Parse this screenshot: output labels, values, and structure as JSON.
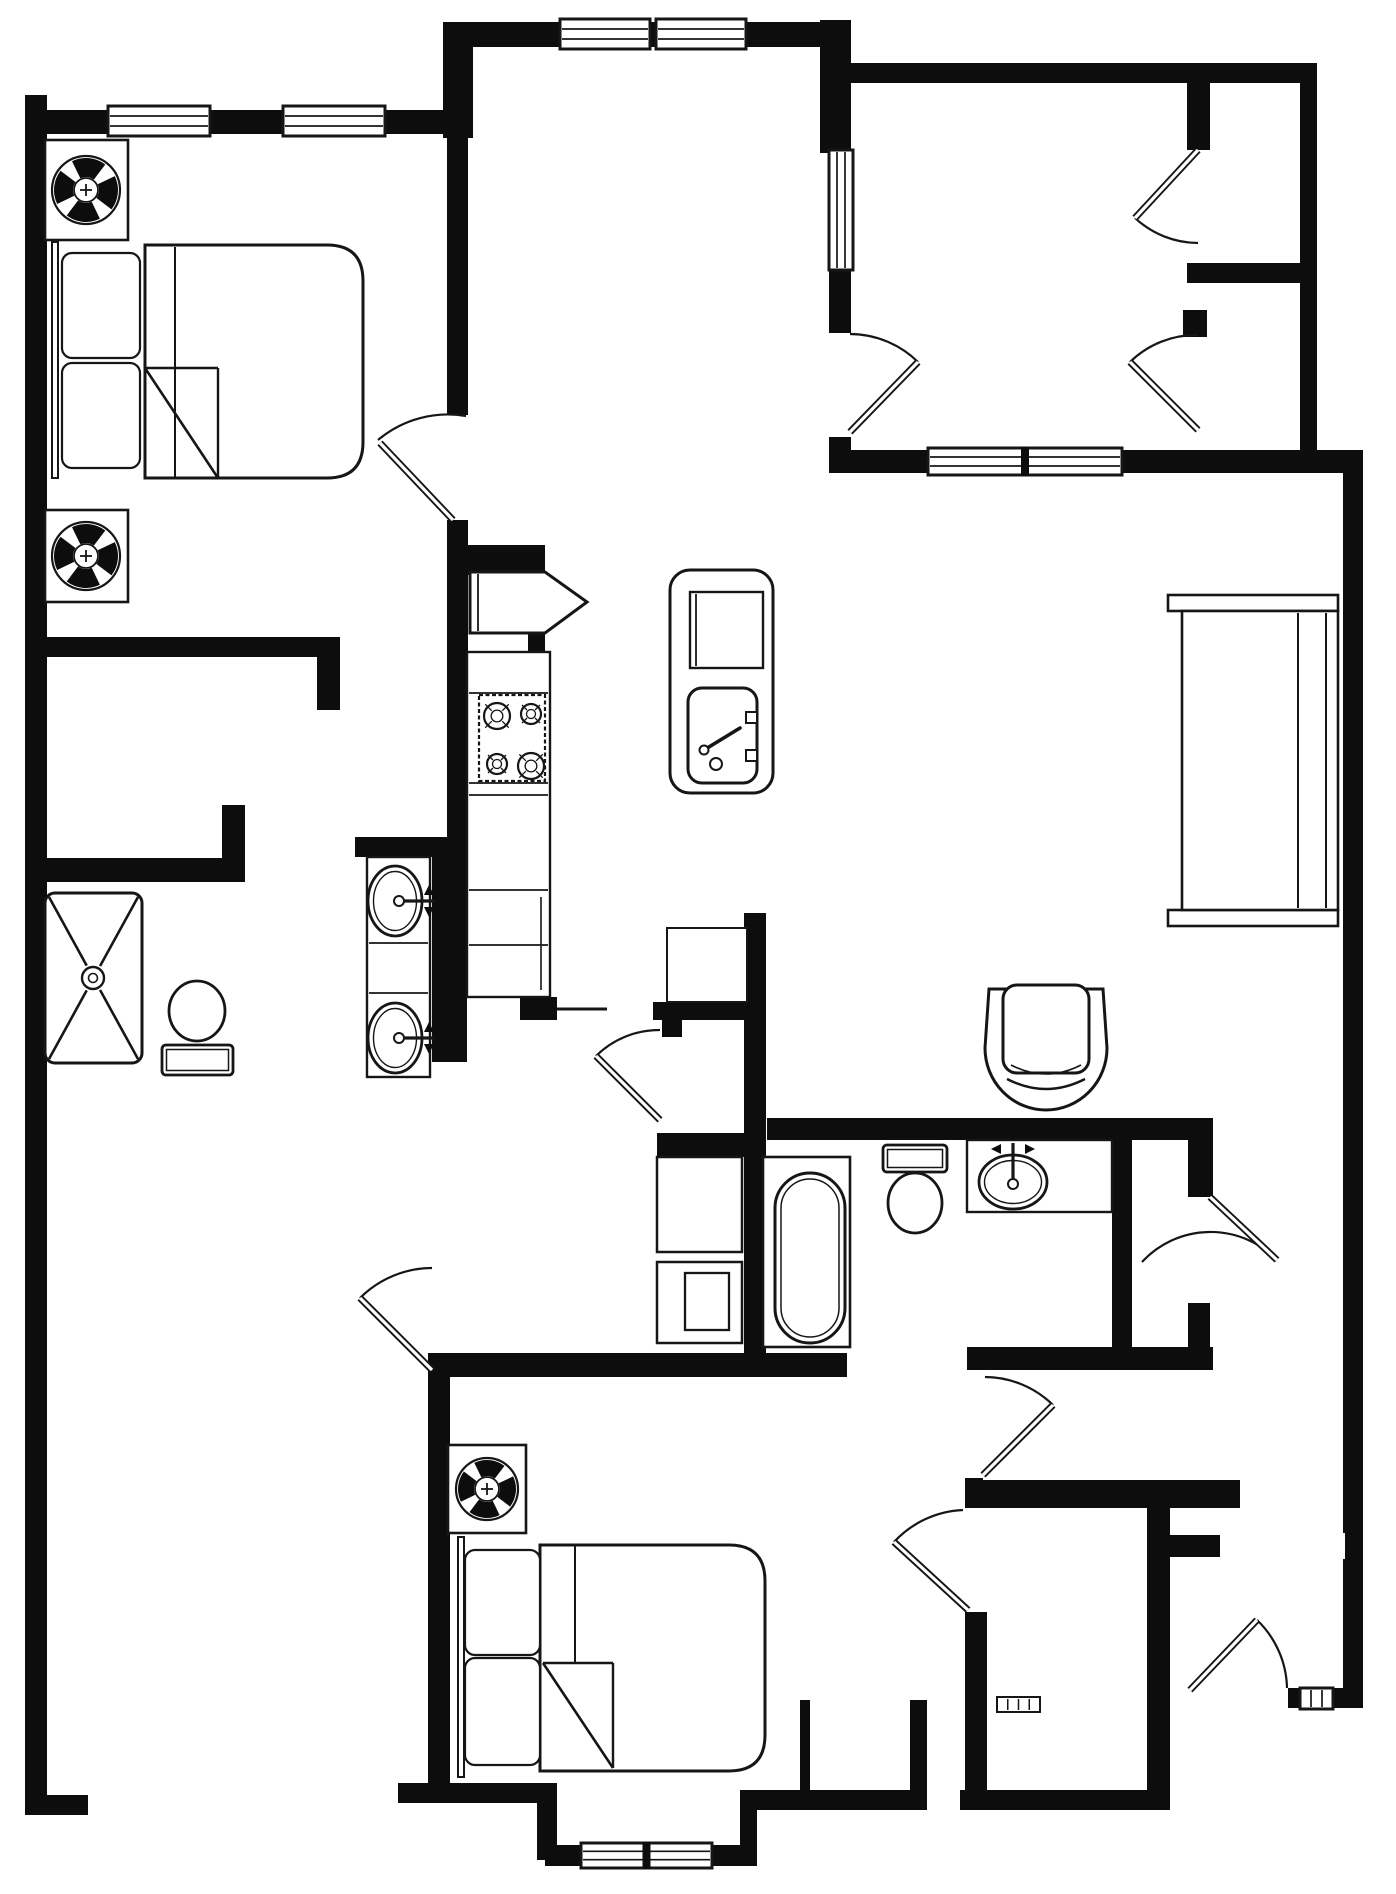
{
  "plan": {
    "type": "floor-plan",
    "canvas": {
      "w": 1396,
      "h": 1894
    },
    "colors": {
      "wall": "#0d0d0d",
      "line": "#161616",
      "bg": "#ffffff"
    },
    "walls": [
      [
        25,
        95,
        22,
        1702
      ],
      [
        25,
        1795,
        63,
        20
      ],
      [
        25,
        110,
        423,
        24
      ],
      [
        443,
        22,
        30,
        116
      ],
      [
        443,
        22,
        394,
        25
      ],
      [
        820,
        20,
        31,
        133
      ],
      [
        837,
        63,
        480,
        20
      ],
      [
        1300,
        63,
        17,
        410
      ],
      [
        829,
        267,
        22,
        66
      ],
      [
        829,
        437,
        22,
        36
      ],
      [
        837,
        450,
        95,
        23
      ],
      [
        1118,
        450,
        229,
        23
      ],
      [
        1343,
        450,
        20,
        1258
      ],
      [
        1187,
        263,
        113,
        20
      ],
      [
        1187,
        83,
        23,
        67
      ],
      [
        1183,
        310,
        24,
        27
      ],
      [
        43,
        637,
        297,
        20
      ],
      [
        317,
        657,
        23,
        53
      ],
      [
        43,
        858,
        202,
        20
      ],
      [
        222,
        805,
        23,
        73
      ],
      [
        27,
        860,
        218,
        22
      ],
      [
        355,
        837,
        99,
        20
      ],
      [
        447,
        132,
        21,
        283
      ],
      [
        447,
        520,
        21,
        330
      ],
      [
        447,
        545,
        98,
        30
      ],
      [
        528,
        633,
        17,
        20
      ],
      [
        432,
        837,
        35,
        225
      ],
      [
        520,
        997,
        37,
        23
      ],
      [
        653,
        1002,
        94,
        18
      ],
      [
        662,
        1020,
        20,
        17
      ],
      [
        744,
        913,
        22,
        464
      ],
      [
        657,
        1133,
        90,
        24
      ],
      [
        767,
        1118,
        446,
        22
      ],
      [
        1112,
        1140,
        20,
        218
      ],
      [
        1188,
        1140,
        25,
        57
      ],
      [
        1188,
        1303,
        22,
        55
      ],
      [
        967,
        1347,
        246,
        23
      ],
      [
        428,
        1353,
        419,
        24
      ],
      [
        428,
        1353,
        22,
        437
      ],
      [
        398,
        1783,
        159,
        20
      ],
      [
        537,
        1803,
        20,
        57
      ],
      [
        545,
        1845,
        212,
        21
      ],
      [
        740,
        1790,
        17,
        76
      ],
      [
        753,
        1790,
        174,
        20
      ],
      [
        800,
        1700,
        10,
        90
      ],
      [
        910,
        1700,
        17,
        90
      ],
      [
        965,
        1478,
        18,
        30
      ],
      [
        965,
        1480,
        275,
        28
      ],
      [
        1147,
        1507,
        23,
        303
      ],
      [
        965,
        1612,
        22,
        178
      ],
      [
        960,
        1790,
        210,
        20
      ],
      [
        1170,
        1535,
        50,
        22
      ],
      [
        1288,
        1688,
        55,
        20
      ]
    ],
    "notches": [
      [
        1333,
        1533,
        12,
        26
      ]
    ],
    "windows": [
      [
        108,
        106,
        102,
        30,
        "h",
        0
      ],
      [
        283,
        106,
        102,
        30,
        "h",
        0
      ],
      [
        560,
        19,
        90,
        30,
        "h",
        0
      ],
      [
        656,
        19,
        90,
        30,
        "h",
        0
      ],
      [
        829,
        150,
        24,
        120,
        "v",
        0
      ],
      [
        928,
        448,
        194,
        27,
        "h",
        1
      ],
      [
        581,
        1843,
        131,
        25,
        "h",
        1
      ],
      [
        1300,
        1688,
        33,
        21,
        "v",
        0
      ]
    ],
    "doors": [
      {
        "name": "bedroom-1-door",
        "hinge": [
          453,
          520
        ],
        "leaf": [
          380,
          443
        ],
        "arc": [
          378,
          440,
          108,
          466,
          416,
          1
        ]
      },
      {
        "name": "upper-closet-door",
        "hinge": [
          1198,
          150
        ],
        "leaf": [
          1135,
          218
        ],
        "arc": [
          1198,
          243,
          93,
          1135,
          218,
          1
        ]
      },
      {
        "name": "lower-closet-door",
        "hinge": [
          1198,
          430
        ],
        "leaf": [
          1130,
          362
        ],
        "arc": [
          1130,
          362,
          95,
          1198,
          335,
          1
        ]
      },
      {
        "name": "right-room-door",
        "hinge": [
          850,
          432
        ],
        "leaf": [
          918,
          362
        ],
        "arc": [
          850,
          334,
          98,
          918,
          362,
          1
        ]
      },
      {
        "name": "laundry-door",
        "hinge": [
          660,
          1120
        ],
        "leaf": [
          596,
          1056
        ],
        "arc": [
          660,
          1030,
          90,
          596,
          1056,
          0
        ]
      },
      {
        "name": "suite-hall-door",
        "hinge": [
          432,
          1370
        ],
        "leaf": [
          360,
          1298
        ],
        "arc": [
          432,
          1268,
          102,
          360,
          1298,
          0
        ]
      },
      {
        "name": "bath-hall-door",
        "hinge": [
          983,
          1475
        ],
        "leaf": [
          1053,
          1405
        ],
        "arc": [
          985,
          1377,
          98,
          1053,
          1405,
          1
        ]
      },
      {
        "name": "bedroom-2-door",
        "hinge": [
          968,
          1610
        ],
        "leaf": [
          894,
          1542
        ],
        "arc": [
          963,
          1510,
          100,
          894,
          1542,
          0
        ]
      },
      {
        "name": "master-bedroom-door",
        "hinge": [
          1210,
          1197
        ],
        "leaf": [
          1277,
          1260
        ],
        "arc": [
          1142,
          1262,
          93,
          1277,
          1260,
          1
        ]
      },
      {
        "name": "entry-door",
        "hinge": [
          1190,
          1690
        ],
        "leaf": [
          1257,
          1620
        ],
        "arc": [
          1287,
          1688,
          97,
          1257,
          1620,
          0
        ]
      }
    ],
    "lines": [
      [
        557,
        1009,
        607,
        1009
      ]
    ],
    "fans": [
      {
        "box": [
          45,
          140,
          83,
          100
        ],
        "cx": 86,
        "cy": 190,
        "r": 34
      },
      {
        "box": [
          45,
          510,
          83,
          92
        ],
        "cx": 86,
        "cy": 556,
        "r": 34
      },
      {
        "box": [
          448,
          1445,
          78,
          88
        ],
        "cx": 487,
        "cy": 1489,
        "r": 31
      }
    ],
    "beds": [
      {
        "name": "bed-1",
        "headboard": [
          52,
          242,
          6,
          236
        ],
        "pillows": [
          [
            62,
            253,
            78,
            105
          ],
          [
            62,
            363,
            78,
            105
          ]
        ],
        "mattress": [
          145,
          245,
          218,
          233
        ],
        "rx": 36,
        "blanket": [
          175,
          247,
          175,
          477
        ],
        "fold": [
          145,
          368,
          218,
          478
        ]
      },
      {
        "name": "bed-2",
        "headboard": [
          458,
          1537,
          6,
          240
        ],
        "pillows": [
          [
            465,
            1550,
            75,
            105
          ],
          [
            465,
            1658,
            75,
            107
          ]
        ],
        "mattress": [
          540,
          1545,
          225,
          226
        ],
        "rx": 36,
        "blanket": [
          575,
          1546,
          575,
          1663
        ],
        "fold": [
          543,
          1663,
          613,
          1768
        ]
      }
    ],
    "kitchen": {
      "counter": {
        "outer": [
          467,
          652,
          83,
          345
        ],
        "hlines": [
          693,
          783,
          795,
          890,
          945
        ],
        "vline": [
          541,
          897,
          990
        ]
      },
      "stove": {
        "rect": [
          479,
          695,
          66,
          86
        ],
        "burners": [
          [
            497,
            716,
            13
          ],
          [
            531,
            714,
            10
          ],
          [
            497,
            764,
            10
          ],
          [
            531,
            766,
            13
          ]
        ]
      },
      "fridge": {
        "poly": [
          [
            470,
            572
          ],
          [
            545,
            572
          ],
          [
            587,
            602
          ],
          [
            545,
            633
          ],
          [
            470,
            633
          ]
        ],
        "inner": [
          478,
          574,
          478,
          631
        ]
      },
      "island": {
        "outer": [
          670,
          570,
          103,
          223
        ],
        "board": [
          690,
          592,
          73,
          76
        ],
        "boardline": [
          696,
          594,
          696,
          666
        ],
        "sink": [
          688,
          688,
          69,
          95
        ],
        "drain": [
          716,
          764,
          6
        ],
        "lever": [
          [
            704,
            750
          ],
          [
            740,
            728
          ]
        ],
        "knobs": [
          [
            746,
            712,
            11,
            11
          ],
          [
            746,
            750,
            11,
            11
          ]
        ]
      }
    },
    "bath1": {
      "shower": {
        "rect": [
          45,
          893,
          97,
          170
        ],
        "drain": [
          93,
          978,
          11
        ]
      },
      "toilet": {
        "tank": [
          162,
          1045,
          71,
          30
        ],
        "bowl": [
          197,
          1011,
          28,
          30
        ],
        "tank_on_top": true
      },
      "vanity": {
        "counter": [
          367,
          857,
          63,
          220
        ],
        "dividers": [
          943,
          993
        ],
        "sinks": [
          [
            395,
            901,
            27,
            35
          ],
          [
            395,
            1038,
            27,
            35
          ]
        ],
        "dir": "right"
      }
    },
    "bath2": {
      "laundry": {
        "washer": [
          657,
          1157,
          85,
          95
        ],
        "dryer": [
          657,
          1262,
          85,
          81
        ],
        "dryer_door": [
          685,
          1273,
          44,
          57
        ]
      },
      "linen": [
        667,
        928,
        80,
        74
      ],
      "tub": {
        "surround": [
          763,
          1157,
          87,
          190
        ],
        "tub": [
          775,
          1173,
          70,
          170
        ],
        "inner": [
          781,
          1179,
          58,
          158
        ]
      },
      "toilet": {
        "tank": [
          883,
          1145,
          64,
          27
        ],
        "bowl": [
          915,
          1203,
          27,
          30
        ],
        "tank_on_top": false
      },
      "vanity": {
        "counter": [
          967,
          1140,
          145,
          72
        ],
        "sinks": [
          [
            1013,
            1182,
            34,
            27
          ]
        ],
        "dir": "up"
      }
    },
    "living": {
      "shelving": {
        "caps": [
          [
            1168,
            595,
            170,
            16
          ],
          [
            1168,
            910,
            170,
            16
          ]
        ],
        "body": [
          1182,
          611,
          156,
          299
        ],
        "vlines": [
          1298,
          1326
        ]
      },
      "armchair": {
        "x": 985,
        "y": 987,
        "w": 122,
        "h": 125
      }
    },
    "misc": {
      "vent": [
        997,
        1697,
        43,
        15
      ]
    }
  }
}
